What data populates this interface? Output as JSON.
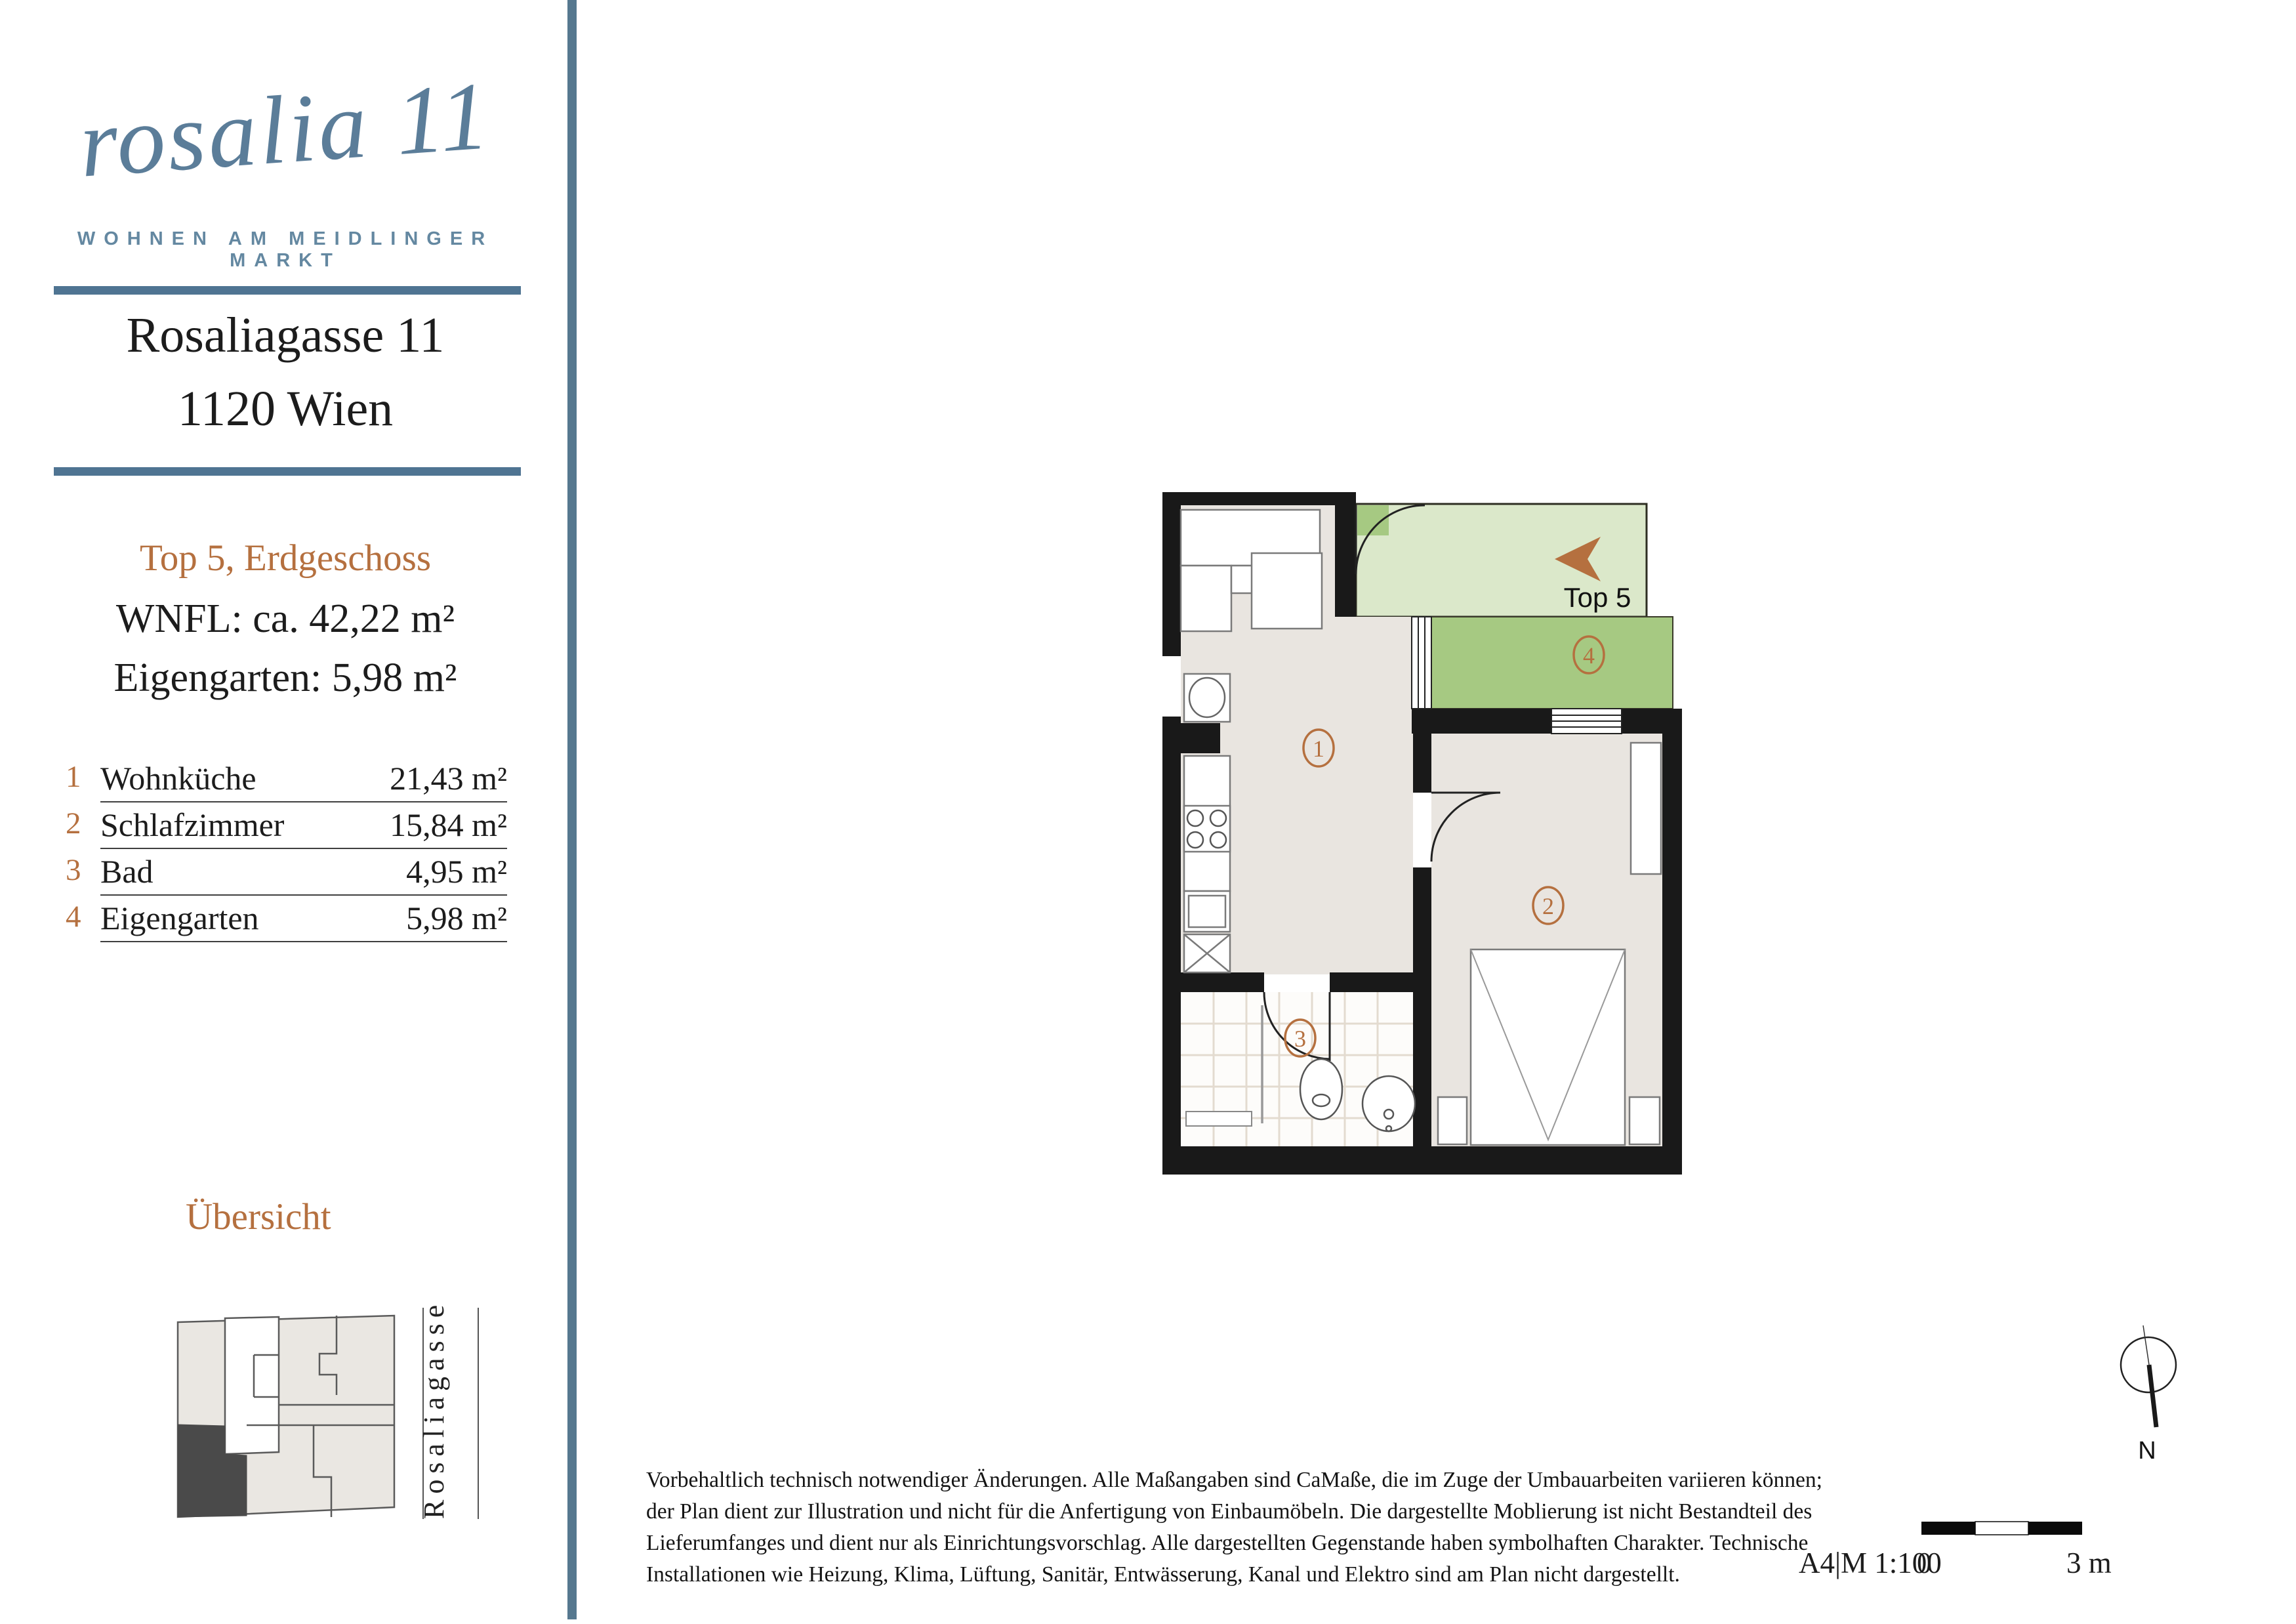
{
  "brand": {
    "logo_text": "rosalia 11",
    "tagline": "WOHNEN AM MEIDLINGER MARKT"
  },
  "address": {
    "line1": "Rosaliagasse 11",
    "line2": "1120 Wien"
  },
  "unit": {
    "title": "Top 5, Erdgeschoss",
    "wnfl": "WNFL: ca. 42,22 m²",
    "eigengarten": "Eigengarten: 5,98 m²"
  },
  "rooms": [
    {
      "nr": "1",
      "name": "Wohnküche",
      "area": "21,43 m²"
    },
    {
      "nr": "2",
      "name": "Schlafzimmer",
      "area": "15,84 m²"
    },
    {
      "nr": "3",
      "name": "Bad",
      "area": "4,95 m²"
    },
    {
      "nr": "4",
      "name": "Eigengarten",
      "area": "5,98 m²"
    }
  ],
  "overview": {
    "title": "Übersicht",
    "street_label": "Rosaliagasse"
  },
  "plan": {
    "entrance_label": "Top 5",
    "room1": "1",
    "room2": "2",
    "room3": "3",
    "room4": "4"
  },
  "footer": {
    "disclaimer_lines": [
      "Vorbehaltlich technisch notwendiger Änderungen. Alle Maßangaben sind CaMaße, die im Zuge der Umbauarbeiten variieren können;",
      "der Plan dient zur Illustration und nicht für die Anfertigung von Einbaumöbeln. Die dargestellte Moblierung ist nicht Bestandteil des",
      "Lieferumfanges und dient nur als Einrichtungsvorschlag. Alle dargestellten Gegenstande haben symbolhaften Charakter. Technische",
      "Installationen wie Heizung, Klima, Lüftung, Sanitär, Entwässerung, Kanal und Elektro sind am Plan nicht dargestellt."
    ],
    "format_scale": "A4|M 1:100",
    "scale_start": "0",
    "scale_end": "3 m",
    "north_label": "N"
  },
  "colors": {
    "accent_orange": "#b5703f",
    "brand_blue": "#5b7d99",
    "rule_blue": "#4f7492",
    "divider_blue": "#56788f",
    "floor_beige": "#e9e5e0",
    "garden_light": "#dbe8ca",
    "garden_green": "#a6c982",
    "wall_black": "#191919",
    "overview_dark": "#4a4a4a"
  }
}
